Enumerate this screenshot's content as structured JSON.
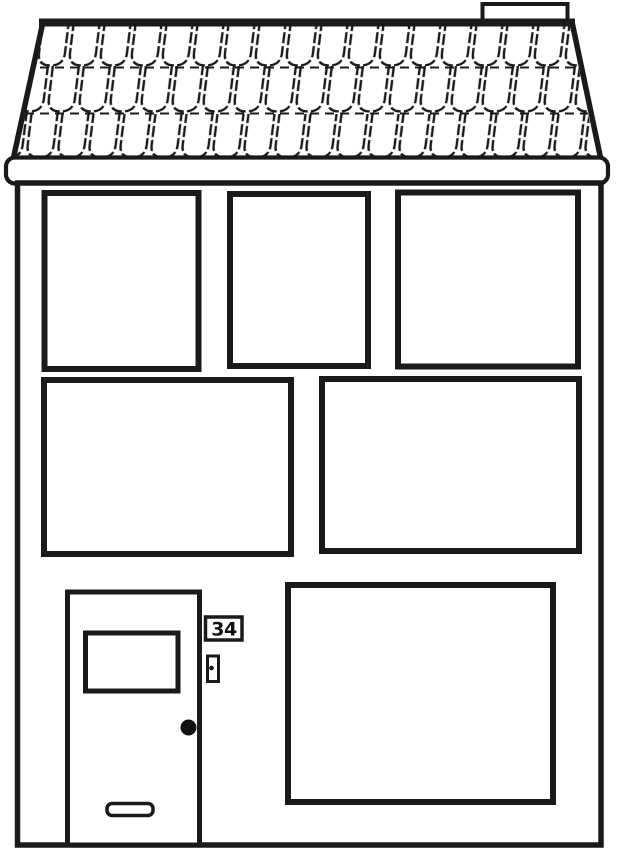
{
  "illustration": {
    "description": "Black and white line drawing of a two-storey house, coloring-page style",
    "house_number": "34",
    "roof": {
      "shingle_rows": 3,
      "shingles_per_row": 17,
      "chimney": true
    },
    "windows": {
      "top_row_count": 3,
      "middle_row_count": 2,
      "bottom_row_count": 1
    },
    "door": {
      "features": [
        "door-window",
        "mail-slot",
        "doorknob",
        "doorbell",
        "house-number-plate"
      ]
    },
    "colors": {
      "line": "#1a1a1a",
      "fill": "#ffffff",
      "background": "#ffffff",
      "doorknob": "#111111"
    }
  }
}
